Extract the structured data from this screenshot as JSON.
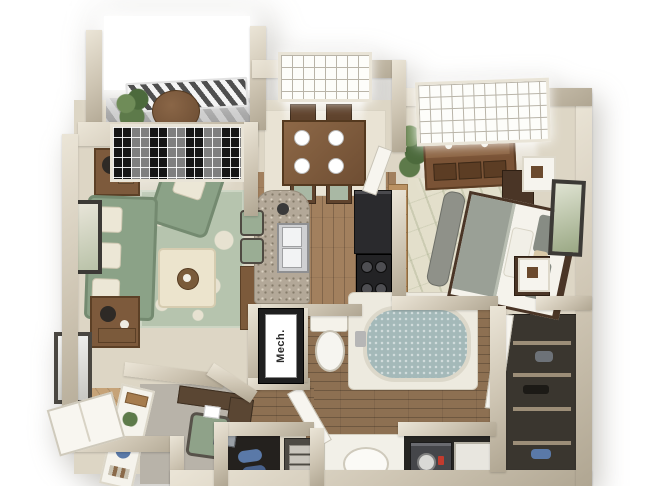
{
  "meta": {
    "description": "Photorealistic 3D top-down (dollhouse) rendering of a one-bedroom, one-bathroom apartment floor plan with balcony",
    "view": "isometric top-down 3D render on white background"
  },
  "labels": {
    "mech_closet": "Mech."
  },
  "rooms": [
    "balcony",
    "living-room",
    "dining-area",
    "kitchen",
    "bedroom",
    "bathroom",
    "walk-in-closet",
    "mechanical-closet",
    "laundry-closet",
    "entry",
    "desk-nook"
  ],
  "furniture_icons": [
    "balcony-table-icon",
    "potted-plant-icon",
    "sofa-icon",
    "armchair-icon",
    "ottoman-icon",
    "damask-rug-icon",
    "side-table-icon",
    "lamp-icon",
    "picture-frame-icon",
    "mirror-icon",
    "dining-table-icon",
    "dining-chair-icon",
    "place-setting-icon",
    "granite-peninsula-icon",
    "double-sink-icon",
    "bar-stool-icon",
    "refrigerator-icon",
    "range-icon",
    "oven-icon",
    "cabinet-icon",
    "toilet-icon",
    "bathtub-icon",
    "vanity-sink-icon",
    "washer-icon",
    "dryer-icon",
    "bed-icon",
    "foot-bench-icon",
    "dresser-icon",
    "nightstand-icon",
    "cube-shelf-icon",
    "bamboo-rug-icon",
    "closet-shelving-icon",
    "entry-door-icon",
    "interior-door-icon",
    "bookshelf-icon",
    "desk-icon",
    "desk-chair-icon",
    "shoe-cubby-icon",
    "drawer-unit-icon",
    "window-icon",
    "railing-icon"
  ],
  "colors": {
    "wall": "#cdc4b2",
    "wall_light": "#ebe5d7",
    "carpet": "#ddd6c5",
    "carpet_gray": "#b8b3a9",
    "wood": "#a2805e",
    "wood_dark": "#8d7052",
    "wood_light": "#c6a378",
    "granite": "#b3a898",
    "rug_green": "#b6c4ae",
    "sofa_green": "#8ba287",
    "cushion_cream": "#ece7d6",
    "table_brown": "#7d5a3c",
    "espresso": "#4a3526",
    "cabinet_wood": "#bb9263",
    "appliance_dark": "#2a2a2d",
    "water": "#a4b9b9",
    "white_fixture": "#f4f2ea",
    "closet_dark": "#3a362f",
    "plant_green": "#5d7a4a",
    "frame_dark": "#3c3a36",
    "gray_fabric": "#8f9189",
    "accent_red": "#c23b2e",
    "denim_blue": "#5a79a8"
  }
}
